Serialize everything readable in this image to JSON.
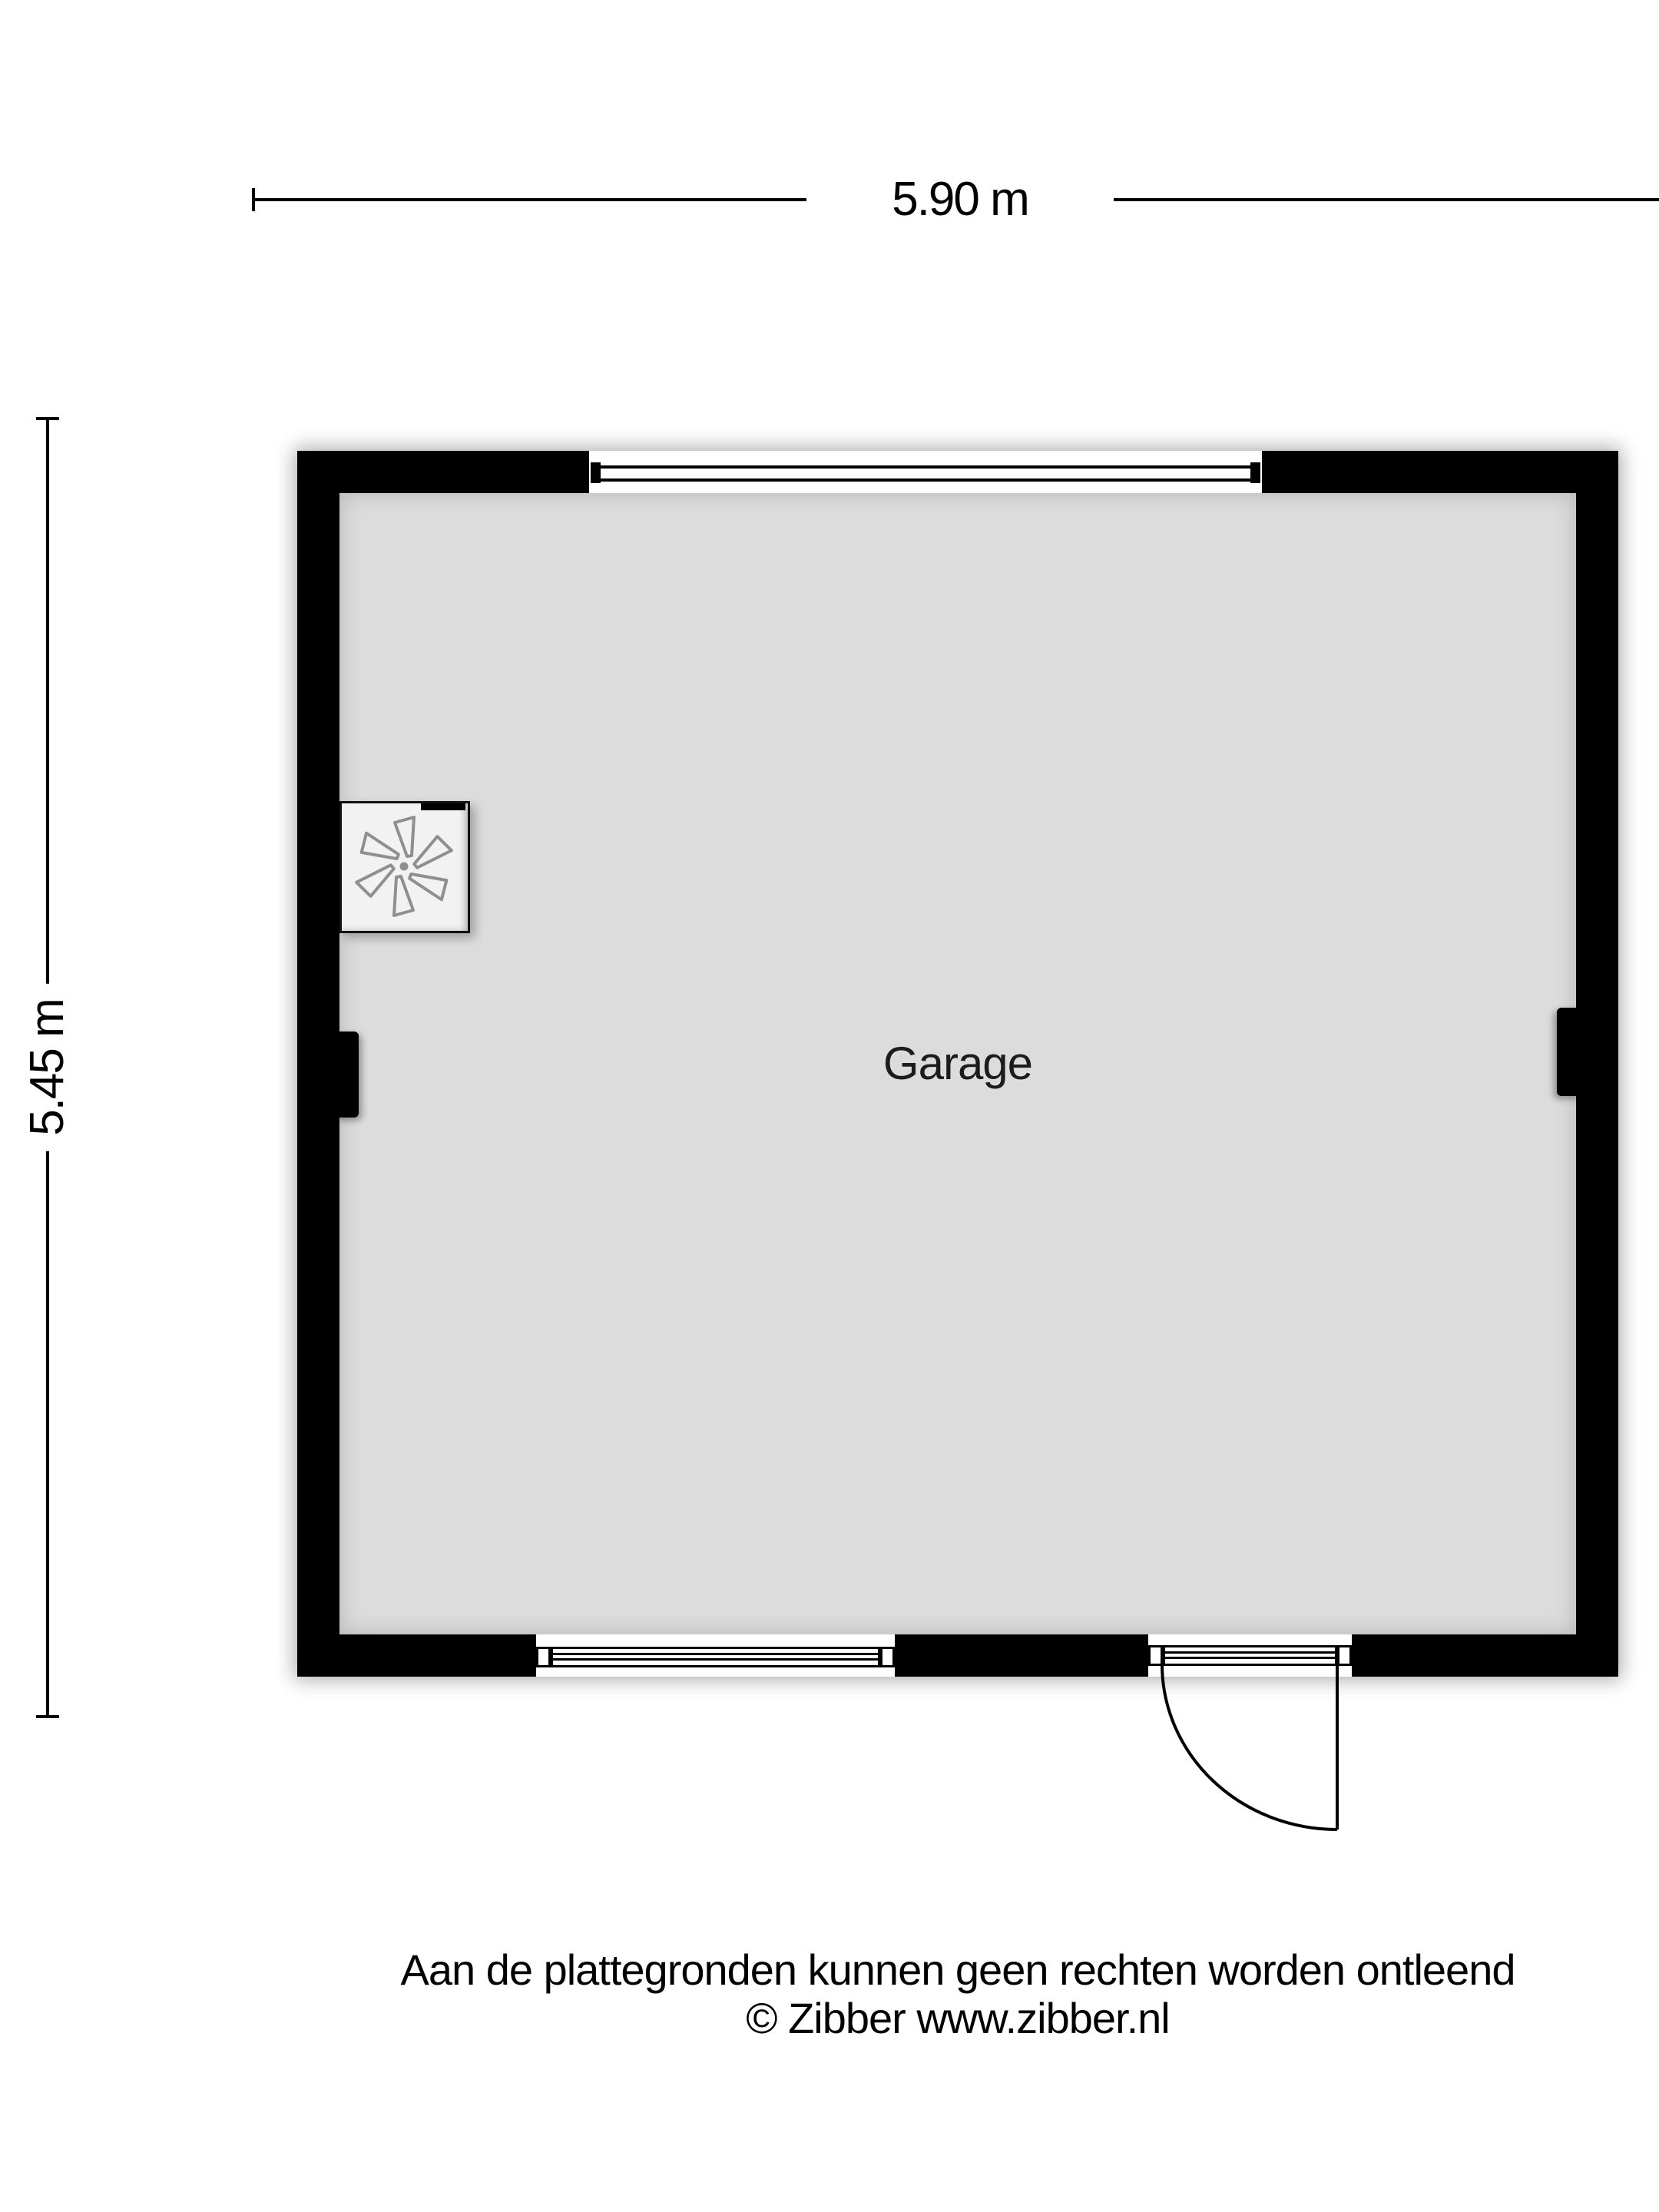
{
  "floorplan": {
    "room": {
      "label": "Garage"
    },
    "dimensions": {
      "width": "5.90 m",
      "height": "5.45 m"
    },
    "fixtures": {
      "fan_unit": {
        "icon": "fan-icon",
        "description": "mechanical ventilation unit"
      }
    },
    "openings": {
      "top_window": "window",
      "bottom_window": "window",
      "entry_door": "hinged door, quarter-circle swing, hinge right"
    }
  },
  "footer": {
    "disclaimer": "Aan de plattegronden kunnen geen rechten worden ontleend",
    "copyright": "© Zibber www.zibber.nl"
  },
  "colors": {
    "wall": "#000000",
    "floor": "#dcdcdc",
    "page_background": "#ffffff",
    "fan_blade_stroke": "#8f8f8f"
  }
}
